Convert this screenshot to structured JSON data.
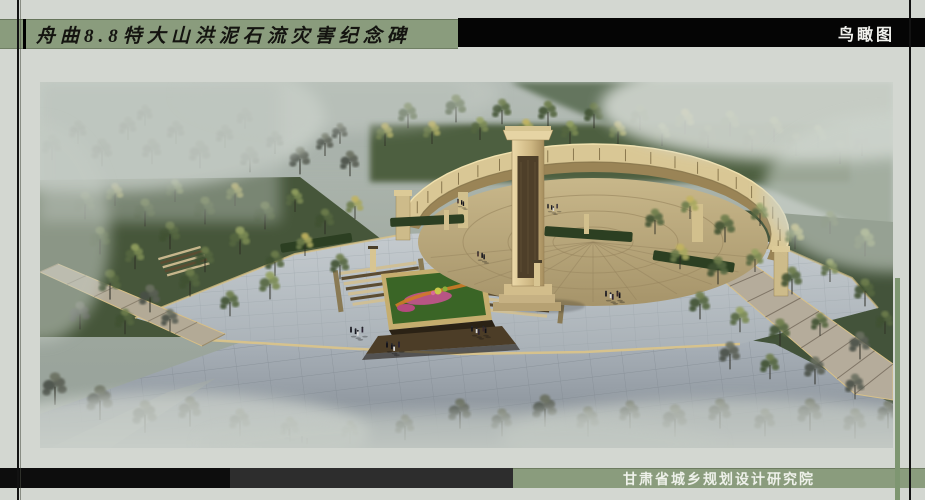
{
  "header": {
    "title": "舟曲8.8特大山洪泥石流灾害纪念碑",
    "view_label": "鸟瞰图"
  },
  "footer": {
    "institute": "甘肃省城乡规划设计研究院"
  },
  "colors": {
    "page_bg": "#d3d7d1",
    "banner_green": "#8a9c7d",
    "banner_black": "#050505",
    "footer_dark": "#0d0d0d",
    "footer_gray": "#2d2d2d",
    "title_text": "#141410",
    "banner_text_light": "#f2f3ef",
    "stone_tan": "#d9c795",
    "plaza_gray": "#b6bec4",
    "foliage_green": "#51623f",
    "mist_gray": "#ccd2cc"
  },
  "scene": {
    "elements": [
      "curved memorial wall",
      "central stele",
      "stepped terraces",
      "flower parterre",
      "tree groves",
      "paved plaza",
      "visitor groups",
      "mist"
    ]
  }
}
